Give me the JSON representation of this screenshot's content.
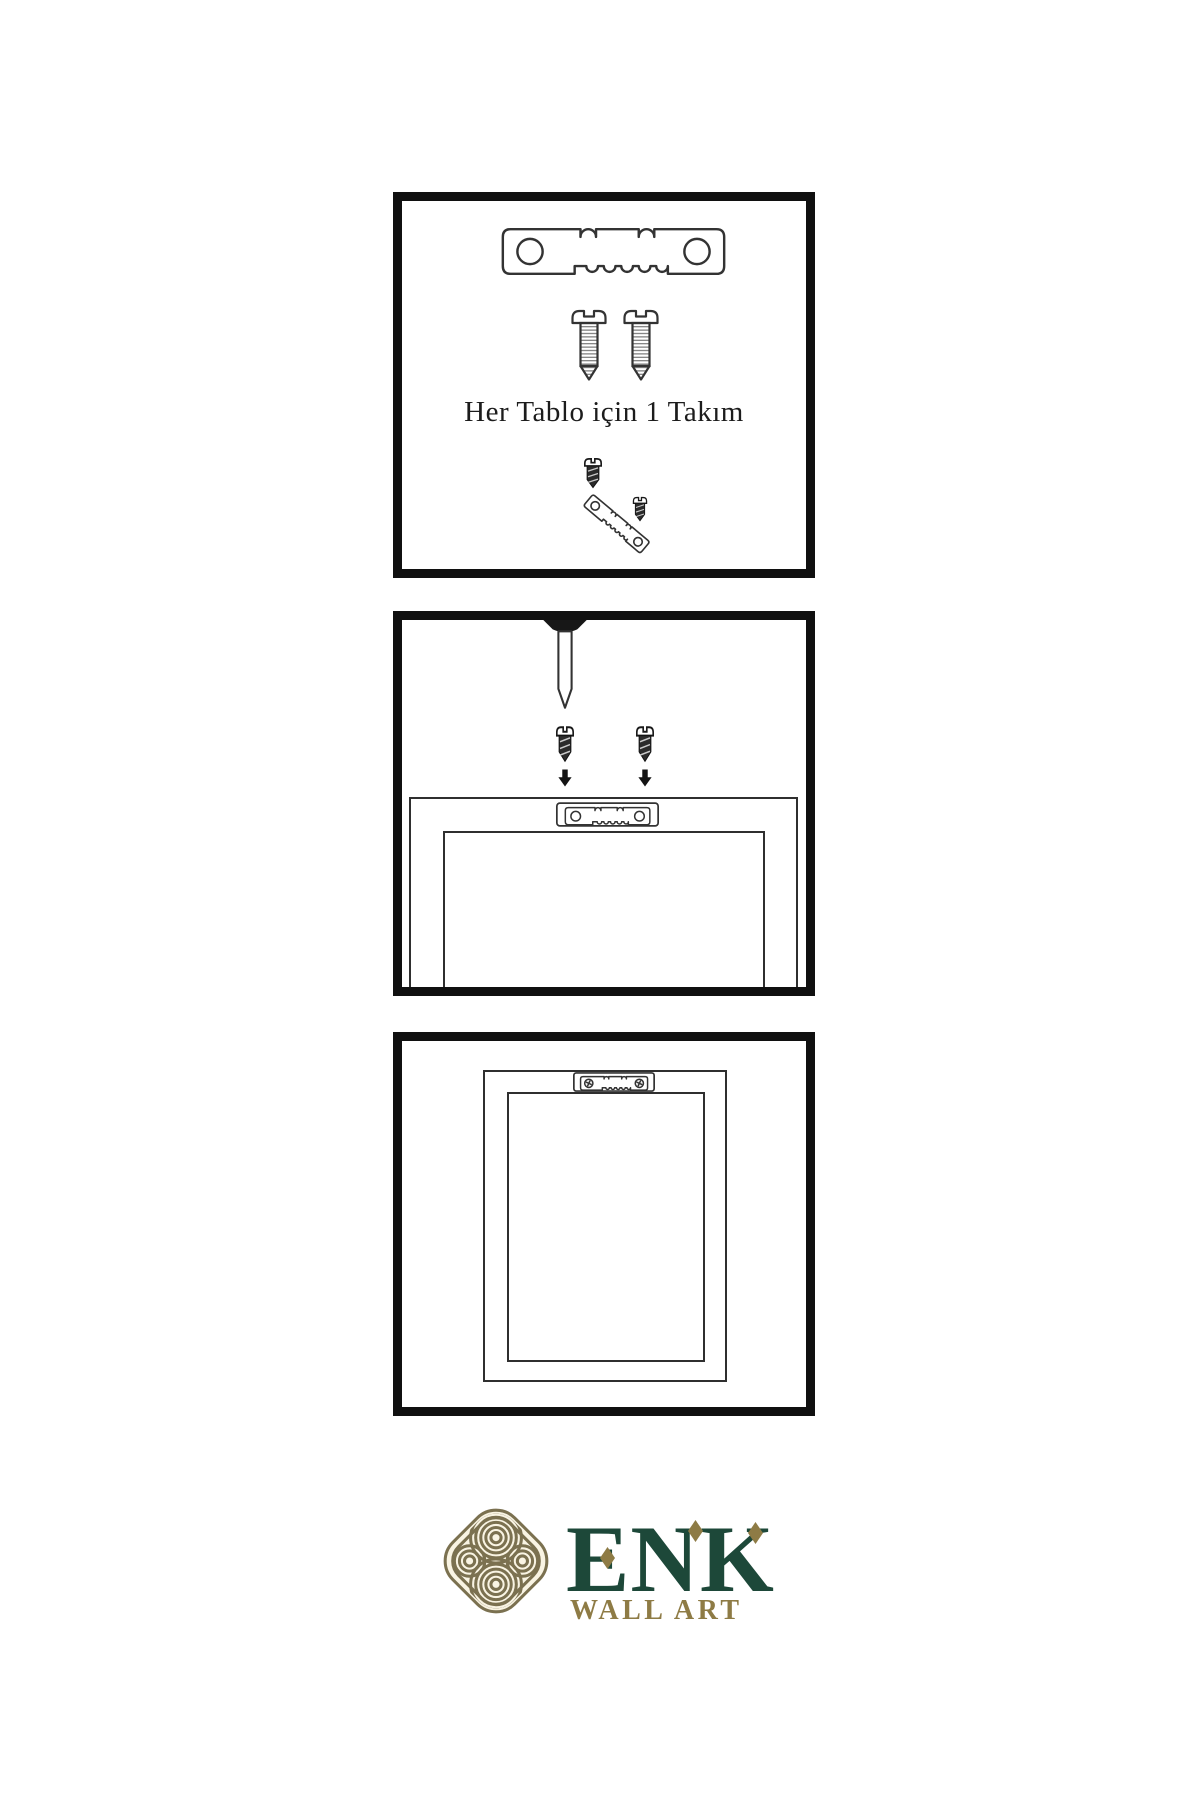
{
  "page": {
    "background": "#ffffff"
  },
  "panels": [
    {
      "name": "hardware-kit",
      "caption": "Her Tablo için 1 Takım",
      "icons": [
        "sawtooth-hanger-icon",
        "screw-icon",
        "screw-icon",
        "dark-screw-icon",
        "tilted-sawtooth-hanger-icon",
        "dark-screw-icon"
      ]
    },
    {
      "name": "mount-hanger-to-frame",
      "icons": [
        "wall-nail-icon",
        "dark-screw-icon",
        "dark-screw-icon",
        "down-arrow-icon",
        "down-arrow-icon",
        "frame-back-icon",
        "sawtooth-hanger-plate-icon"
      ]
    },
    {
      "name": "hanging-frame",
      "icons": [
        "frame-back-icon",
        "sawtooth-hanger-plate-with-screws-icon"
      ]
    }
  ],
  "brand": {
    "wordmark": "ENK",
    "tagline": "WALL ART",
    "logo": "celtic-knot-icon",
    "colors": {
      "green": "#1d4839",
      "gold": "#8e7b45",
      "knot_olive": "#7b7150",
      "knot_cream": "#f9f4e3"
    }
  },
  "colors": {
    "panel_border": "#101010",
    "line_art": "#333333",
    "dark_metal": "#2a2a2a"
  }
}
